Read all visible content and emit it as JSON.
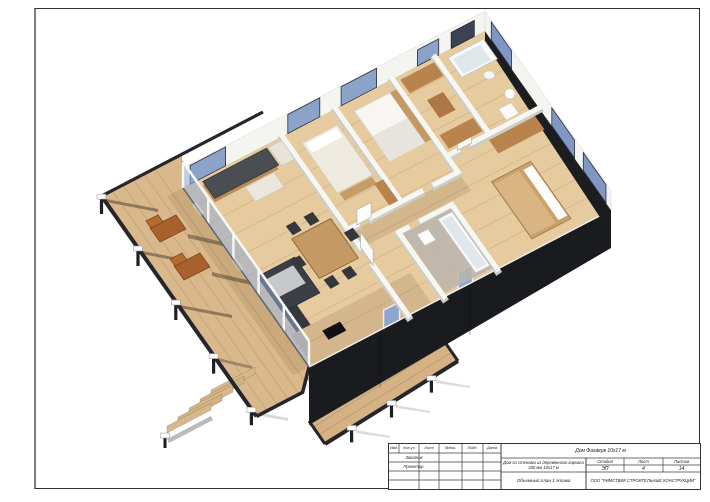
{
  "title_block": {
    "revision_columns": [
      "Изм.",
      "Кол.уч",
      "Лист",
      "№док.",
      "Подп.",
      "Дата"
    ],
    "role_rows": [
      "Заказчик",
      "Проектир."
    ],
    "project_name": "Дом Фахверк 10х17 м",
    "object_name_line1": "Дом со стенами из деревянного каркаса",
    "object_name_line2": "200 мм 10х17 м",
    "drawing_title": "Объемный план 1 этажа",
    "stage": {
      "label": "Стадия",
      "value": "ЭП"
    },
    "sheet_no": {
      "label": "Лист",
      "value": "4"
    },
    "sheets_total": {
      "label": "Листов",
      "value": "14"
    },
    "company": "ООО \"РИМСТВИК СТРОИТЕЛЬНЫЕ КОНСТРУКЦИИ\""
  },
  "colors": {
    "floor_wood": "#e6cb9f",
    "deck_wood": "#d9b98c",
    "walkway_wood": "#d5b285",
    "exterior_wall_dark": "#1a1b1f",
    "glass_blue": "#93aacf",
    "glass_dark": "#3c4254",
    "wall_white": "#f4f4f1",
    "counter_dark": "#4a4d52",
    "sofa_dark": "#3b3e44",
    "wood_furniture": "#c49963",
    "wood_shelf": "#b9834e",
    "lounge_orange": "#a8602c"
  }
}
